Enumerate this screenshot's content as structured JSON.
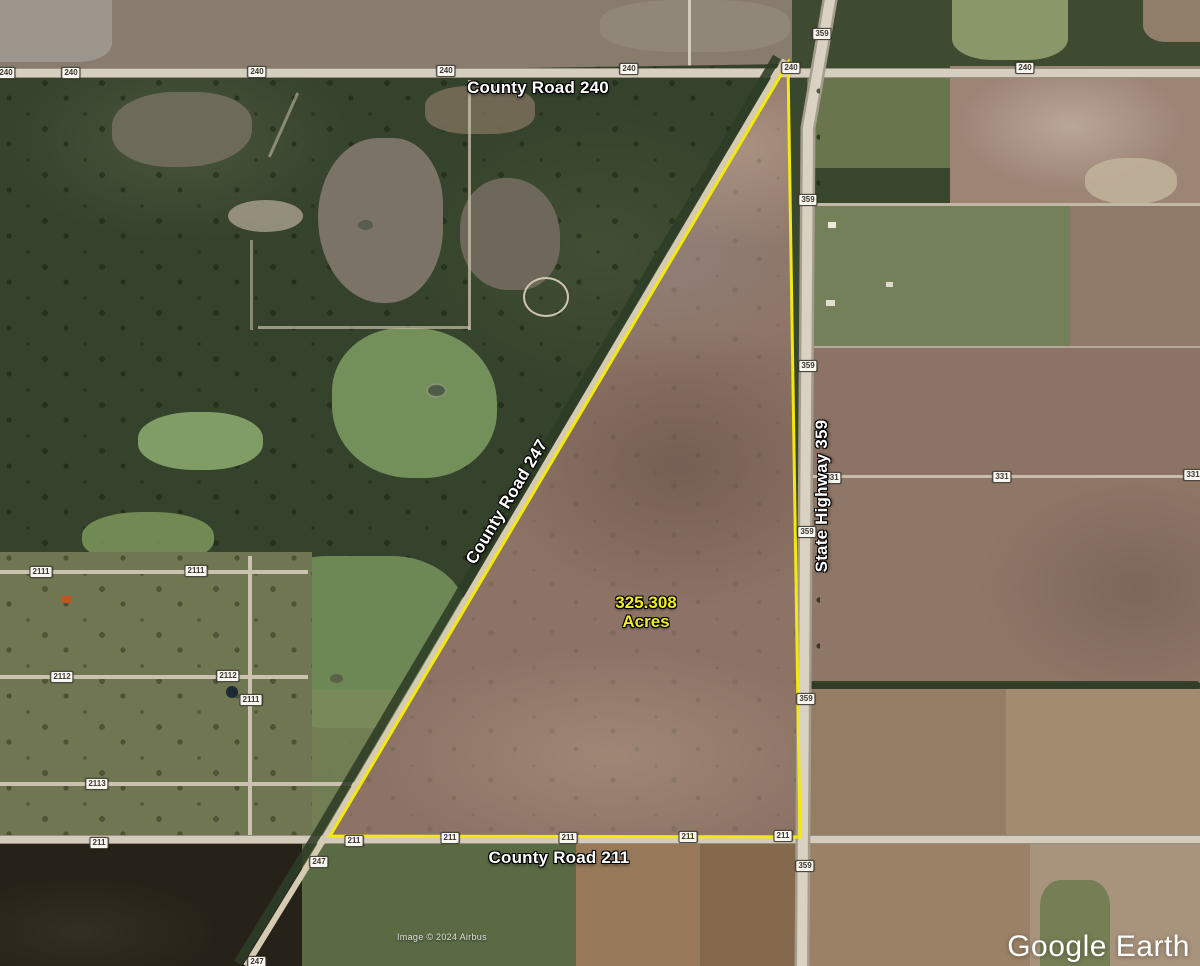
{
  "map_labels": {
    "county_road_240": "County Road 240",
    "county_road_247": "County Road 247",
    "state_highway_359": "State Highway 359",
    "county_road_211": "County Road 211"
  },
  "parcel": {
    "acreage_value": "325.308",
    "acreage_unit": "Acres",
    "acreage_color": "#f2ee1a",
    "boundary_color": "#f4e90f"
  },
  "road_badges": [
    {
      "label": "240",
      "x": 6,
      "y": 73
    },
    {
      "label": "240",
      "x": 71,
      "y": 73
    },
    {
      "label": "240",
      "x": 257,
      "y": 72
    },
    {
      "label": "240",
      "x": 446,
      "y": 71
    },
    {
      "label": "240",
      "x": 629,
      "y": 69
    },
    {
      "label": "240",
      "x": 791,
      "y": 68
    },
    {
      "label": "240",
      "x": 1025,
      "y": 68
    },
    {
      "label": "359",
      "x": 822,
      "y": 34
    },
    {
      "label": "359",
      "x": 808,
      "y": 200
    },
    {
      "label": "359",
      "x": 808,
      "y": 366
    },
    {
      "label": "359",
      "x": 807,
      "y": 532
    },
    {
      "label": "359",
      "x": 806,
      "y": 699
    },
    {
      "label": "359",
      "x": 805,
      "y": 866
    },
    {
      "label": "211",
      "x": 99,
      "y": 843
    },
    {
      "label": "211",
      "x": 354,
      "y": 841
    },
    {
      "label": "211",
      "x": 450,
      "y": 838
    },
    {
      "label": "211",
      "x": 568,
      "y": 838
    },
    {
      "label": "211",
      "x": 688,
      "y": 837
    },
    {
      "label": "211",
      "x": 783,
      "y": 836
    },
    {
      "label": "247",
      "x": 319,
      "y": 862
    },
    {
      "label": "247",
      "x": 257,
      "y": 962
    },
    {
      "label": "2111",
      "x": 41,
      "y": 572
    },
    {
      "label": "2111",
      "x": 196,
      "y": 571
    },
    {
      "label": "2111",
      "x": 251,
      "y": 700
    },
    {
      "label": "2112",
      "x": 62,
      "y": 677
    },
    {
      "label": "2112",
      "x": 228,
      "y": 676
    },
    {
      "label": "2113",
      "x": 97,
      "y": 784
    },
    {
      "label": "331",
      "x": 832,
      "y": 478
    },
    {
      "label": "331",
      "x": 1002,
      "y": 477
    },
    {
      "label": "331",
      "x": 1193,
      "y": 475
    }
  ],
  "attribution": "Image © 2024 Airbus",
  "logo": {
    "google": "Google",
    "earth": "Earth"
  }
}
